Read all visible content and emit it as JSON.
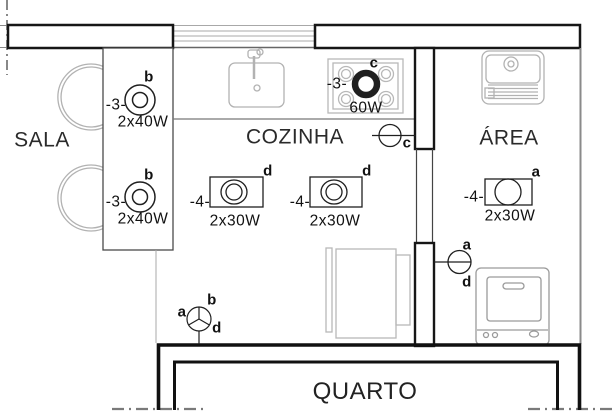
{
  "rooms": {
    "sala": "SALA",
    "cozinha": "COZINHA",
    "area": "ÁREA",
    "quarto": "QUARTO"
  },
  "fixtures": {
    "sala1": {
      "circuit": "-3-",
      "switch_letter": "b",
      "power": "2x40W"
    },
    "sala2": {
      "circuit": "-3-",
      "switch_letter": "b",
      "power": "2x40W"
    },
    "stove": {
      "circuit": "-3-",
      "switch_letter": "c",
      "power": "60W"
    },
    "cozinha1": {
      "circuit": "-4-",
      "switch_letter": "d",
      "power": "2x30W"
    },
    "cozinha2": {
      "circuit": "-4-",
      "switch_letter": "d",
      "power": "2x30W"
    },
    "area1": {
      "circuit": "-4-",
      "switch_letter": "a",
      "power": "2x30W"
    }
  },
  "switches": {
    "cozinha_wall": {
      "letter": "c"
    },
    "area_wall": {
      "top": "a",
      "bottom": "d"
    },
    "hall": {
      "left": "a",
      "top": "b",
      "right": "d"
    }
  },
  "colors": {
    "wall": "#161616",
    "line": "#222222",
    "furniture": "#b0b0b0",
    "background": "#ffffff"
  }
}
